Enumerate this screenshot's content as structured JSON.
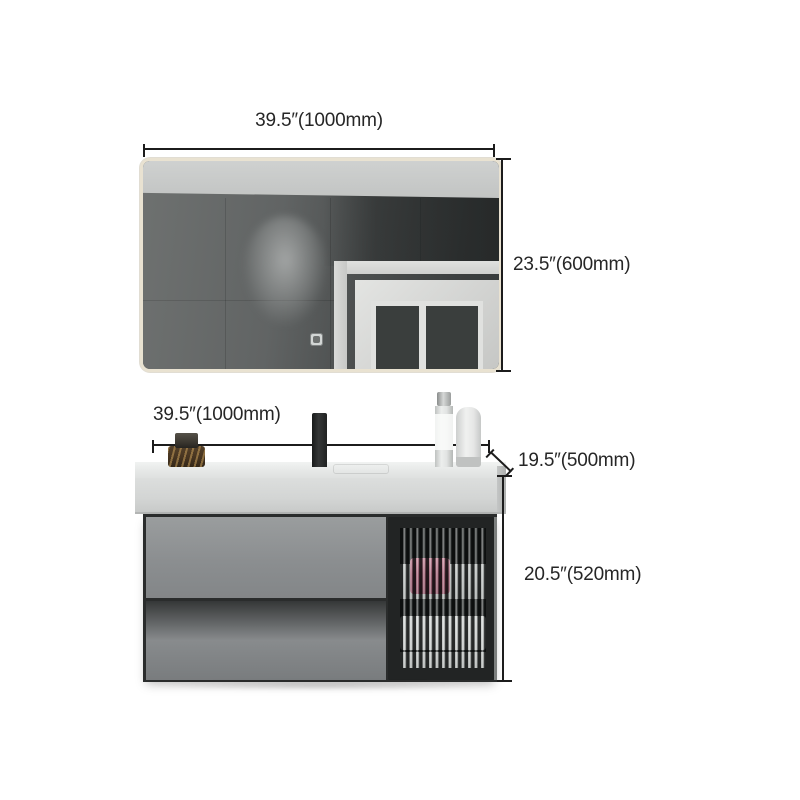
{
  "figure": {
    "type": "product-dimension-diagram",
    "subject": "wall-mounted bathroom vanity set with framed mirror, integrated sink counter, black faucet, two drawers and fluted-glass door cabinet"
  },
  "dimensions": {
    "mirror_width": {
      "label": "39.5″(1000mm)"
    },
    "mirror_height": {
      "label": "23.5″(600mm)"
    },
    "vanity_width": {
      "label": "39.5″(1000mm)"
    },
    "vanity_depth": {
      "label": "19.5″(500mm)"
    },
    "cabinet_height": {
      "label": "20.5″(520mm)"
    }
  },
  "colors": {
    "background": "#ffffff",
    "dimension_line": "#1c1c1c",
    "label_text": "#262626",
    "mirror_frame": "#e9e2d1",
    "mirror_wall_reflection": "#4b4e4e",
    "counter": "#dcdedd",
    "drawer_gray": "#8b8e90",
    "glass_door_frame": "#222424",
    "towel_accent": "#a94b69"
  }
}
